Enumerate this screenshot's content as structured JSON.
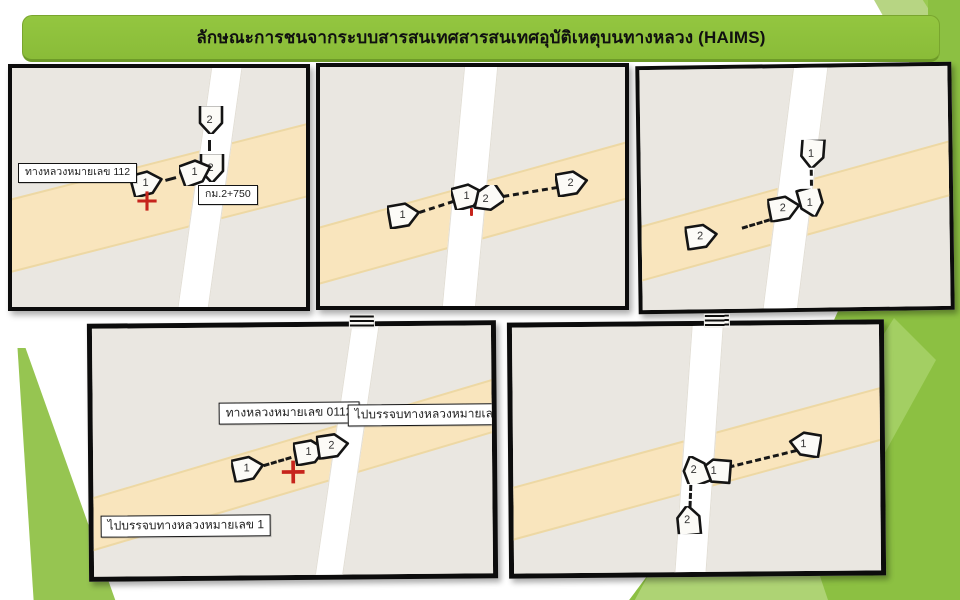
{
  "slide": {
    "title": "ลักษณะการชนจากระบบสารสนเทศสารสนเทศอุบัติเหตุบนทางหลวง (HAIMS)"
  },
  "colors": {
    "accent_green": "#8cc042",
    "banner_green": "#8abc38",
    "map_background": "#eae7e1",
    "highway_band_fill": "#f9e5bd",
    "highway_band_edge": "#edd8a4",
    "minor_road": "#ffffff",
    "marker_fill": "#fcfbf7",
    "marker_stroke": "#141414",
    "crash_cross_red": "#c6241c"
  },
  "panels": [
    {
      "name": "map-panel-top-left",
      "box": {
        "left": 8,
        "top": 64,
        "width": 302,
        "height": 247,
        "rotate": 0,
        "border": 4
      },
      "band": {
        "cx": 143,
        "cy": 129,
        "angle": -14.3,
        "t": 68,
        "len": 430
      },
      "road": {
        "cx": 197,
        "cy": 116,
        "angle": 8,
        "w": 29,
        "len": 330
      },
      "markers": [
        {
          "n": "2",
          "x": 199,
          "y": 52,
          "rot": 90
        },
        {
          "n": "2",
          "x": 200,
          "y": 100,
          "rot": 90
        },
        {
          "n": "1",
          "x": 184,
          "y": 104,
          "rot": -20
        },
        {
          "n": "1",
          "x": 135,
          "y": 115,
          "rot": -15
        }
      ],
      "dashes": [
        {
          "x1": 199,
          "y1": 72,
          "x2": 199,
          "y2": 83
        },
        {
          "x1": 153,
          "y1": 111,
          "x2": 164,
          "y2": 108
        }
      ],
      "marks": [
        {
          "kind": "cross",
          "x": 135,
          "y": 133,
          "size": 22
        }
      ],
      "labels": [
        {
          "text": "ทางหลวงหมายเลข 112",
          "x": 6,
          "y": 95
        },
        {
          "text": "กม.2+750",
          "x": 186,
          "y": 117
        }
      ],
      "label_size": 10.5
    },
    {
      "name": "map-panel-top-middle",
      "box": {
        "left": 316,
        "top": 63,
        "width": 313,
        "height": 247,
        "rotate": 0,
        "border": 4
      },
      "band": {
        "cx": 153,
        "cy": 144,
        "angle": -15.5,
        "t": 52,
        "len": 450
      },
      "road": {
        "cx": 149,
        "cy": 120,
        "angle": 5.3,
        "w": 32,
        "len": 330
      },
      "markers": [
        {
          "n": "1",
          "x": 84,
          "y": 148,
          "rot": -10
        },
        {
          "n": "1",
          "x": 148,
          "y": 129,
          "rot": -15
        },
        {
          "n": "2",
          "x": 167,
          "y": 132,
          "rot": 145
        },
        {
          "n": "2",
          "x": 252,
          "y": 116,
          "rot": -10
        }
      ],
      "dashes": [
        {
          "x1": 99,
          "y1": 144,
          "x2": 133,
          "y2": 133
        },
        {
          "x1": 183,
          "y1": 128,
          "x2": 237,
          "y2": 119
        }
      ],
      "marks": [
        {
          "kind": "tick",
          "x": 150,
          "y": 141
        }
      ],
      "labels": [],
      "label_size": 10.5
    },
    {
      "name": "map-panel-top-right",
      "box": {
        "left": 637,
        "top": 64,
        "width": 316,
        "height": 248,
        "rotate": -0.8,
        "border": 4
      },
      "band": {
        "cx": 154,
        "cy": 141,
        "angle": -14.7,
        "t": 50,
        "len": 470
      },
      "road": {
        "cx": 153,
        "cy": 120,
        "angle": 8,
        "w": 33,
        "len": 340
      },
      "markers": [
        {
          "n": "1",
          "x": 172,
          "y": 86,
          "rot": 95
        },
        {
          "n": "1",
          "x": 170,
          "y": 135,
          "rot": 75
        },
        {
          "n": "2",
          "x": 143,
          "y": 140,
          "rot": -10
        },
        {
          "n": "2",
          "x": 60,
          "y": 167,
          "rot": -8
        }
      ],
      "dashes": [
        {
          "x1": 172,
          "y1": 102,
          "x2": 172,
          "y2": 118
        },
        {
          "x1": 100,
          "y1": 158,
          "x2": 128,
          "y2": 150
        }
      ],
      "marks": [],
      "labels": [],
      "label_size": 10.5
    },
    {
      "name": "map-panel-bottom-left",
      "box": {
        "left": 88,
        "top": 322,
        "width": 409,
        "height": 258,
        "rotate": -0.5,
        "border": 5
      },
      "band": {
        "cx": 200,
        "cy": 136,
        "angle": -16,
        "t": 48,
        "len": 590
      },
      "road": {
        "cx": 253,
        "cy": 125,
        "angle": 8.8,
        "w": 26,
        "len": 350
      },
      "markers": [
        {
          "n": "1",
          "x": 155,
          "y": 141,
          "rot": -12
        },
        {
          "n": "1",
          "x": 217,
          "y": 125,
          "rot": -10
        },
        {
          "n": "2",
          "x": 240,
          "y": 119,
          "rot": -8
        }
      ],
      "dashes": [
        {
          "x1": 170,
          "y1": 137,
          "x2": 198,
          "y2": 129
        }
      ],
      "marks": [
        {
          "kind": "cross",
          "x": 200,
          "y": 145,
          "size": 26
        }
      ],
      "labels": [
        {
          "text": "ทางหลวงหมายเลข 0112",
          "x": 126,
          "y": 75
        },
        {
          "text": "ไปบรรจบทางหลวงหมายเลข 101",
          "x": 255,
          "y": 78
        },
        {
          "text": "ไปบรรจบทางหลวงหมายเลข 1",
          "x": 7,
          "y": 187
        }
      ],
      "label_size": 12,
      "handle": {
        "x": 258,
        "y": -11
      }
    },
    {
      "name": "map-panel-bottom-right",
      "box": {
        "left": 508,
        "top": 321,
        "width": 377,
        "height": 256,
        "rotate": -0.5,
        "border": 5
      },
      "band": {
        "cx": 183,
        "cy": 136,
        "angle": -14.7,
        "t": 48,
        "len": 540
      },
      "road": {
        "cx": 185,
        "cy": 124,
        "angle": 4.5,
        "w": 30,
        "len": 350
      },
      "markers": [
        {
          "n": "1",
          "x": 292,
          "y": 119,
          "rot": 190
        },
        {
          "n": "1",
          "x": 202,
          "y": 145,
          "rot": 185
        },
        {
          "n": "2",
          "x": 182,
          "y": 144,
          "rot": 250
        },
        {
          "n": "2",
          "x": 175,
          "y": 194,
          "rot": 265
        }
      ],
      "dashes": [
        {
          "x1": 215,
          "y1": 140,
          "x2": 283,
          "y2": 124
        },
        {
          "x1": 179,
          "y1": 159,
          "x2": 178,
          "y2": 181
        }
      ],
      "marks": [],
      "labels": [],
      "label_size": 10.5,
      "handle": {
        "x": 193,
        "y": -11
      }
    }
  ]
}
